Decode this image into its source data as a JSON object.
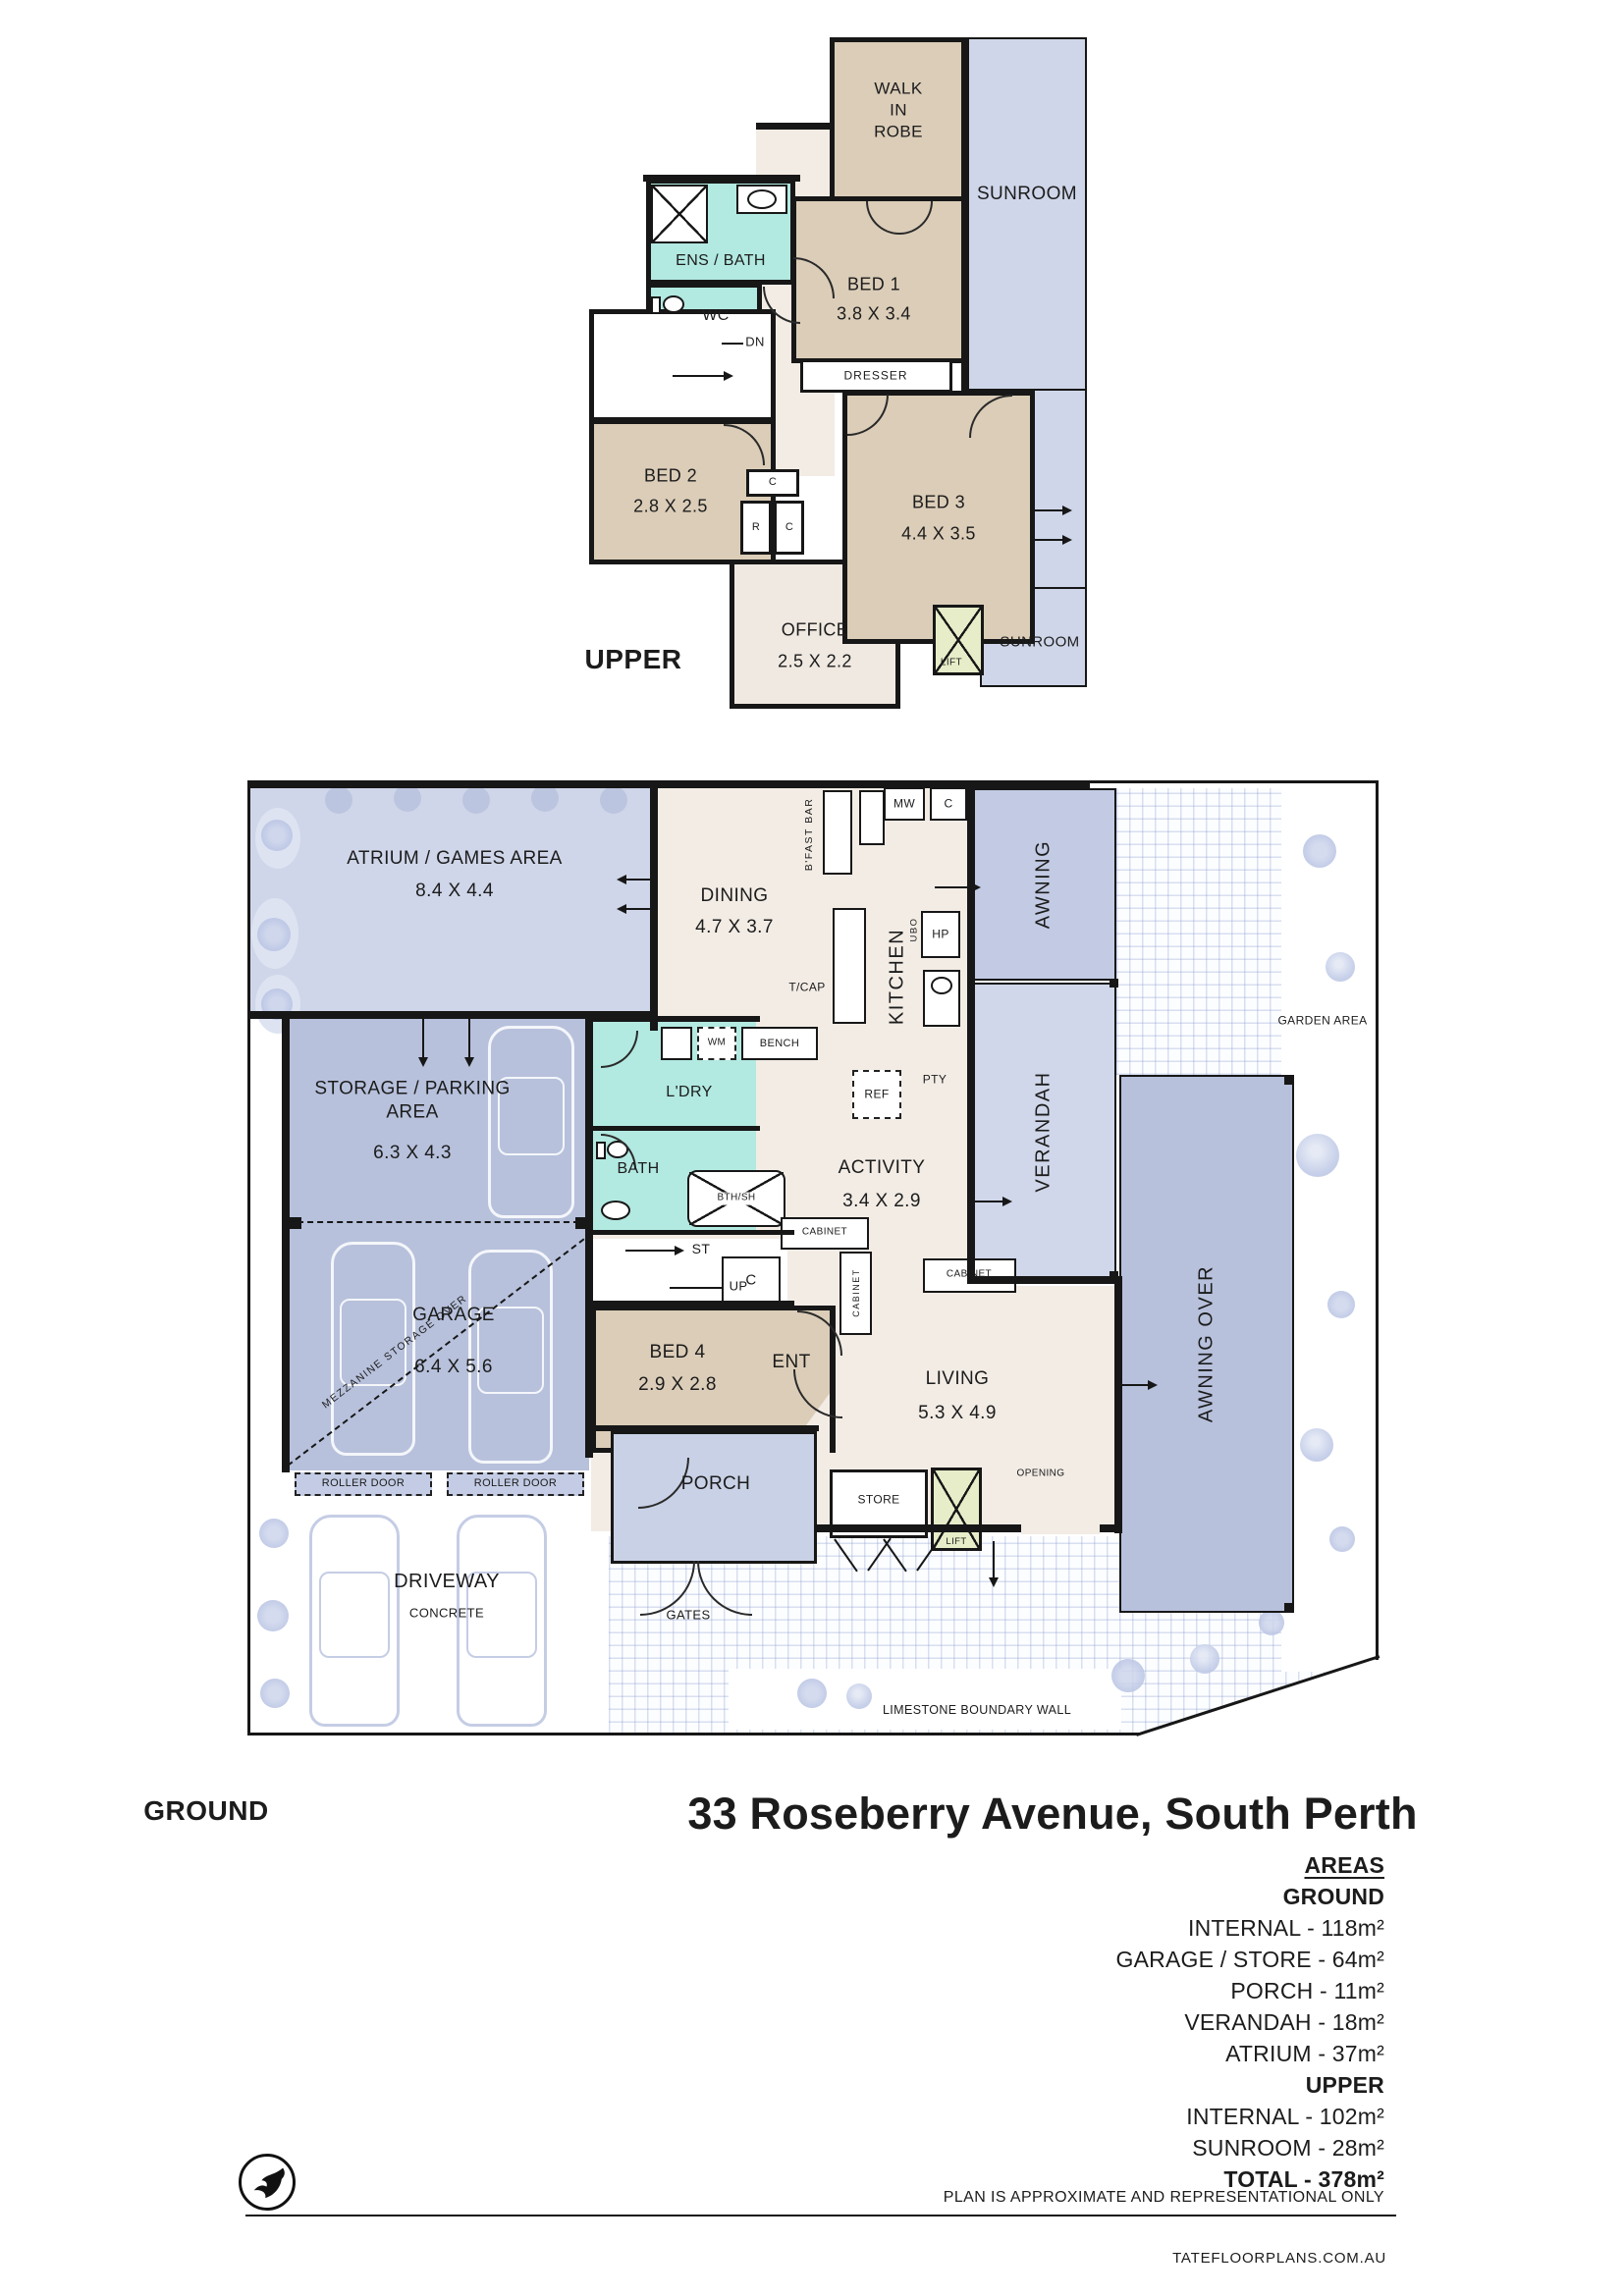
{
  "title": "33 Roseberry Avenue, South Perth",
  "colors": {
    "wall": "#171717",
    "bedroom_tan": "#dbcdb8",
    "interior_cream": "#f2ece5",
    "wet_area_teal": "#b2e9e1",
    "outdoor_light_blue": "#cfd6e9",
    "covered_mid_blue": "#bcc6e0",
    "lift_green": "#e6edc8"
  },
  "upper": {
    "floor_label": "UPPER",
    "wir": "WALK\nIN\nROBE",
    "sunroom": "SUNROOM",
    "sunroom_lower": "SUNROOM",
    "ens_bath": "ENS / BATH",
    "wc": "WC",
    "dn": "DN",
    "dresser": "DRESSER",
    "bed1": "BED 1",
    "bed1_dim": "3.8 X 3.4",
    "bed2": "BED 2",
    "bed2_dim": "2.8 X 2.5",
    "bed3": "BED 3",
    "bed3_dim": "4.4 X 3.5",
    "office": "OFFICE",
    "office_dim": "2.5 X 2.2",
    "c": "C",
    "r": "R",
    "lift": "LIFT"
  },
  "ground": {
    "floor_label": "GROUND",
    "atrium": "ATRIUM / GAMES AREA",
    "atrium_dim": "8.4 X 4.4",
    "dining": "DINING",
    "dining_dim": "4.7 X 3.7",
    "bfast": "B'FAST BAR",
    "mw": "MW",
    "c": "C",
    "kitchen": "KITCHEN",
    "ubo": "UBO",
    "hp": "HP",
    "tcap": "T/CAP",
    "ref": "REF",
    "pty": "PTY",
    "awning": "AWNING",
    "verandah": "VERANDAH",
    "awning_over": "AWNING OVER",
    "garden": "GARDEN AREA",
    "storage": "STORAGE / PARKING\nAREA",
    "storage_dim": "6.3 X 4.3",
    "wm": "WM",
    "bench": "BENCH",
    "ldry": "L'DRY",
    "bath": "BATH",
    "bthsh": "BTH/SH",
    "activity": "ACTIVITY",
    "activity_dim": "3.4 X 2.9",
    "st": "ST",
    "up": "UP",
    "cabinet": "CABINET",
    "c2": "C",
    "mezz": "MEZZANINE STORAGE OVER",
    "garage": "GARAGE",
    "garage_dim": "6.4 X 5.6",
    "bed4": "BED 4",
    "bed4_dim": "2.9 X 2.8",
    "ent": "ENT",
    "living": "LIVING",
    "living_dim": "5.3 X 4.9",
    "opening": "OPENING",
    "roller": "ROLLER DOOR",
    "porch": "PORCH",
    "store": "STORE",
    "lift": "LIFT",
    "driveway": "DRIVEWAY",
    "concrete": "CONCRETE",
    "gates": "GATES",
    "limestone": "LIMESTONE BOUNDARY WALL"
  },
  "areas": {
    "heading": "AREAS",
    "ground_heading": "GROUND",
    "ground_items": [
      "INTERNAL - 118m²",
      "GARAGE / STORE - 64m²",
      "PORCH - 11m²",
      "VERANDAH - 18m²",
      "ATRIUM - 37m²"
    ],
    "upper_heading": "UPPER",
    "upper_items": [
      "INTERNAL - 102m²",
      "SUNROOM - 28m²"
    ],
    "total": "TOTAL - 378m²"
  },
  "footer": {
    "disclaimer": "PLAN IS APPROXIMATE AND REPRESENTATIONAL ONLY",
    "website": "TATEFLOORPLANS.COM.AU"
  }
}
